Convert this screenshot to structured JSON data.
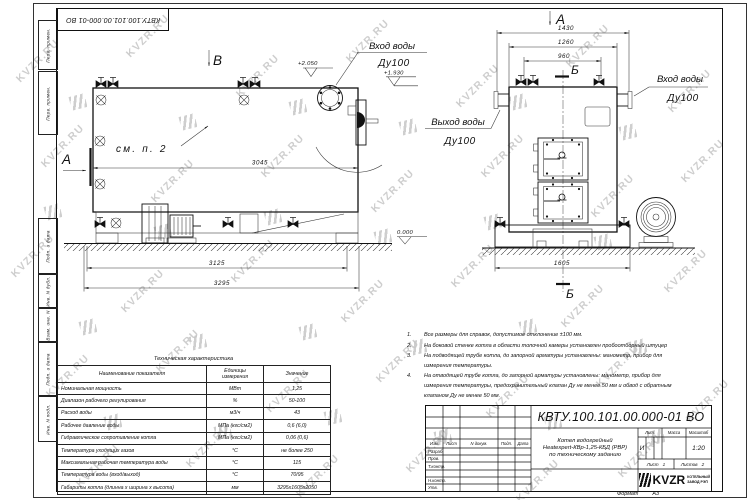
{
  "watermark": {
    "text": "KVZR.RU"
  },
  "colors": {
    "ink": "#1a1a1a",
    "watermark": "#c6c6c6",
    "logo_black": "#111111"
  },
  "frame": {
    "top_ref": "КВТУ.100.101.00.000-01 ВО",
    "margin_labels": [
      "Перв. примен.",
      "Перв. примен.",
      "Подп. и дата",
      "Инв. N дубл.",
      "Взам. инв. N",
      "Подп. и дата",
      "Инв. N подл."
    ]
  },
  "drawing": {
    "side_view": {
      "view_label": "В",
      "section_label": "А",
      "see_note": "см. п. 2",
      "inlet_title": "Вход воды",
      "inlet_size": "Ду100",
      "elev_top": "+2.050",
      "elev_nozzle": "+1.930",
      "elev_zero": "0.000",
      "dim_body": "3045",
      "dim_frame": "3125",
      "dim_overall": "3295"
    },
    "front_view": {
      "view_label": "А",
      "section_top": "Б",
      "section_bottom": "Б",
      "outlet_title": "Выход воды",
      "outlet_size": "Ду100",
      "inlet_title": "Вход воды",
      "inlet_size": "Ду100",
      "dim_overall": "1430",
      "dim_nozzles": "1260",
      "dim_valves": "960",
      "dim_base": "1605"
    }
  },
  "notes": [
    {
      "num": "1.",
      "text": "Все размеры для справок, допустимое отклонение ±100 мм."
    },
    {
      "num": "2.",
      "text": "На боковой стенке котла в области топочной камеры установлен пробоотборный штуцер"
    },
    {
      "num": "3.",
      "text": "На подводящей трубе котла, до запорной арматуры установлены: манометр, прибор для измерения температуры."
    },
    {
      "num": "4.",
      "text": "На отводящей трубе котла, до запорной арматуры установлены: манометр, прибор для измерения температуры, предохранительный клапан Ду не менее 50 мм и обвод с обратным клапаном Ду не менее 50 мм."
    }
  ],
  "spec_table": {
    "title": "Техническая характеристика",
    "headers": [
      "Наименование показателя",
      "Единицы измерения",
      "Значение"
    ],
    "rows": [
      [
        "Номинальная мощность",
        "МВт",
        "1,25"
      ],
      [
        "Диапазон рабочего регулирования",
        "%",
        "50-100"
      ],
      [
        "Расход воды",
        "м3/ч",
        "43"
      ],
      [
        "Рабочее давление воды",
        "МПа (кгс/см2)",
        "0,6 (6,0)"
      ],
      [
        "Гидравлическое сопротивление котла",
        "МПа (кгс/см2)",
        "0,06 (0,6)"
      ],
      [
        "Температура уходящих газов",
        "°С",
        "не более 250"
      ],
      [
        "Максимальная рабочая температура воды",
        "°С",
        "115"
      ],
      [
        "Температура воды (вход/выход)",
        "°С",
        "70/95"
      ],
      [
        "Габариты котла (длинна х ширина х высота)",
        "мм",
        "3295х1605х2050"
      ]
    ]
  },
  "stamp": {
    "doc_number": "КВТУ.100.101.00.000-01 ВО",
    "title_line1": "Котел водогрейный",
    "title_line2": "Heatexpert-КВр-1,25-КБД (РВР)",
    "title_line3": "по техническому заданию",
    "col_izm": "Изм.",
    "col_list": "Лист",
    "col_ndoc": "N докум.",
    "col_podp": "Подп.",
    "col_data": "Дата",
    "role_razrab": "Разраб.",
    "role_prov": "Пров.",
    "role_tkontr": "Т.контр.",
    "role_nkontr": "Н.контр.",
    "role_utv": "Утв.",
    "lit_label": "Лит.",
    "massa_label": "Масса",
    "scale_label": "Масштаб",
    "lit_value": "И",
    "scale_value": "1:20",
    "sheet_label": "Лист",
    "sheet_value": "1",
    "sheets_label": "Листов",
    "sheets_value": "2",
    "brand": "KVZR",
    "brand_sub1": "КОТЕЛЬНЫЙ",
    "brand_sub2": "ЗАВОД РЭП",
    "format_label": "Формат",
    "format_value": "А3"
  }
}
